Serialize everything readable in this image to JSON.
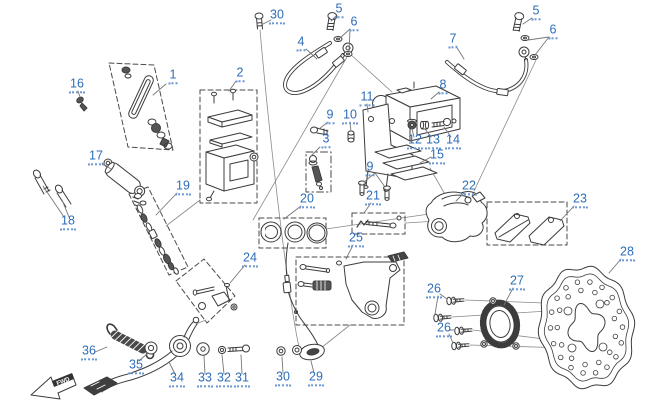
{
  "diagram": {
    "fwd_label": "FWD",
    "colors": {
      "accent": "#2e6db8",
      "line": "#3c3c3c",
      "background": "#ffffff"
    },
    "callouts": [
      {
        "id": "1",
        "num": "1",
        "x": 173,
        "y": 77
      },
      {
        "id": "2",
        "num": "2",
        "x": 240,
        "y": 75
      },
      {
        "id": "3",
        "num": "3",
        "x": 326,
        "y": 141
      },
      {
        "id": "4",
        "num": "4",
        "x": 301,
        "y": 44
      },
      {
        "id": "5-left",
        "num": "5",
        "x": 339,
        "y": 11
      },
      {
        "id": "5-right",
        "num": "5",
        "x": 536,
        "y": 13
      },
      {
        "id": "6-left",
        "num": "6",
        "x": 354,
        "y": 24
      },
      {
        "id": "6-right",
        "num": "6",
        "x": 553,
        "y": 32
      },
      {
        "id": "7",
        "num": "7",
        "x": 453,
        "y": 41
      },
      {
        "id": "8",
        "num": "8",
        "x": 443,
        "y": 87
      },
      {
        "id": "9-upper",
        "num": "9",
        "x": 330,
        "y": 117
      },
      {
        "id": "9-lower",
        "num": "9",
        "x": 370,
        "y": 169
      },
      {
        "id": "10",
        "num": "10",
        "x": 350,
        "y": 117
      },
      {
        "id": "11",
        "num": "11",
        "x": 367,
        "y": 99
      },
      {
        "id": "12",
        "num": "12",
        "x": 415,
        "y": 142
      },
      {
        "id": "13",
        "num": "13",
        "x": 433,
        "y": 142
      },
      {
        "id": "14",
        "num": "14",
        "x": 453,
        "y": 142
      },
      {
        "id": "15",
        "num": "15",
        "x": 437,
        "y": 157
      },
      {
        "id": "16",
        "num": "16",
        "x": 77,
        "y": 86
      },
      {
        "id": "17",
        "num": "17",
        "x": 96,
        "y": 158
      },
      {
        "id": "18",
        "num": "18",
        "x": 68,
        "y": 223
      },
      {
        "id": "19",
        "num": "19",
        "x": 183,
        "y": 188
      },
      {
        "id": "20",
        "num": "20",
        "x": 307,
        "y": 201
      },
      {
        "id": "21",
        "num": "21",
        "x": 373,
        "y": 198
      },
      {
        "id": "22",
        "num": "22",
        "x": 469,
        "y": 188
      },
      {
        "id": "23",
        "num": "23",
        "x": 580,
        "y": 201
      },
      {
        "id": "24",
        "num": "24",
        "x": 250,
        "y": 260
      },
      {
        "id": "25",
        "num": "25",
        "x": 356,
        "y": 240
      },
      {
        "id": "26-upper",
        "num": "26",
        "x": 434,
        "y": 291
      },
      {
        "id": "26-lower",
        "num": "26",
        "x": 444,
        "y": 330
      },
      {
        "id": "27",
        "num": "27",
        "x": 517,
        "y": 283
      },
      {
        "id": "28",
        "num": "28",
        "x": 627,
        "y": 254
      },
      {
        "id": "29",
        "num": "29",
        "x": 316,
        "y": 379
      },
      {
        "id": "30-top",
        "num": "30",
        "x": 277,
        "y": 17
      },
      {
        "id": "30-bottom",
        "num": "30",
        "x": 283,
        "y": 379
      },
      {
        "id": "31",
        "num": "31",
        "x": 242,
        "y": 380
      },
      {
        "id": "32",
        "num": "32",
        "x": 224,
        "y": 380
      },
      {
        "id": "33",
        "num": "33",
        "x": 205,
        "y": 380
      },
      {
        "id": "34",
        "num": "34",
        "x": 177,
        "y": 380
      },
      {
        "id": "35",
        "num": "35",
        "x": 136,
        "y": 367
      },
      {
        "id": "36",
        "num": "36",
        "x": 89,
        "y": 353
      }
    ]
  }
}
